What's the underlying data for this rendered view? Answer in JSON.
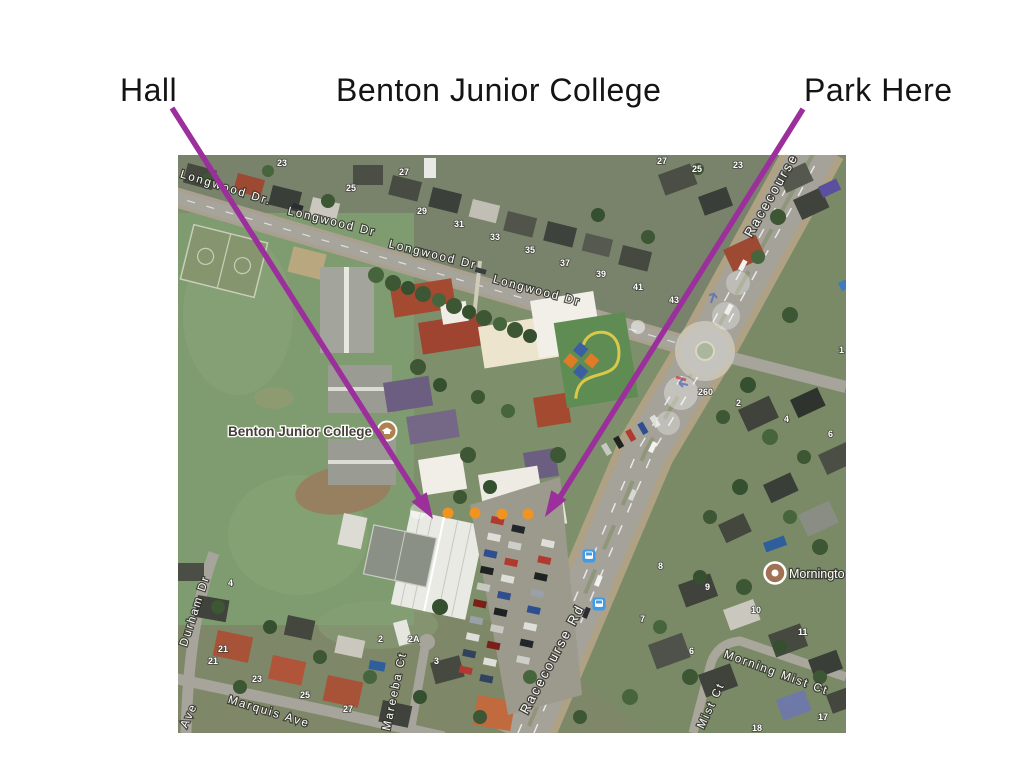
{
  "slide": {
    "labels": [
      {
        "text": "Hall"
      },
      {
        "text": "Benton Junior College"
      },
      {
        "text": "Park Here"
      }
    ],
    "annotation": {
      "arrow_color": "#9B2F9B",
      "dot_color": "#F0941F",
      "dot_count": 4
    }
  },
  "map": {
    "pois": [
      {
        "name": "Benton Junior College",
        "icon": "school-icon"
      },
      {
        "name": "Morningto",
        "icon": "poi-dot-icon"
      }
    ],
    "street_labels": [
      {
        "text": "Longwood Dr."
      },
      {
        "text": "Longwood Dr"
      },
      {
        "text": "Longwood Dr"
      },
      {
        "text": "Longwood Dr"
      },
      {
        "text": "Racecourse"
      },
      {
        "text": "Racecourse Rd"
      },
      {
        "text": "Durham Dr"
      },
      {
        "text": "Ave"
      },
      {
        "text": "Marquis Ave"
      },
      {
        "text": "Mareeba Ct"
      },
      {
        "text": "Morning Mist Ct"
      },
      {
        "text": "Mist Ct"
      }
    ],
    "house_numbers": [
      "23",
      "25",
      "27",
      "29",
      "31",
      "33",
      "35",
      "37",
      "39",
      "41",
      "43",
      "27",
      "25",
      "23",
      "1",
      "260",
      "2",
      "4",
      "6",
      "8",
      "9",
      "10",
      "11",
      "7",
      "6",
      "17",
      "18",
      "4",
      "21",
      "21",
      "23",
      "25",
      "27",
      "2",
      "2A",
      "3"
    ],
    "transit": {
      "icon": "bus-stop-icon",
      "count": 2
    }
  }
}
